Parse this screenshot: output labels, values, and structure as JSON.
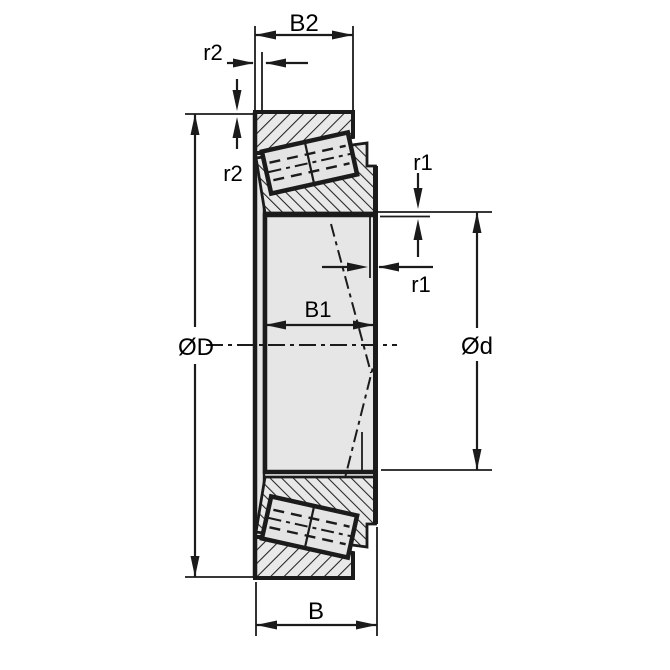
{
  "drawing": {
    "type": "engineering-dimension-drawing",
    "subject": "tapered roller bearing cross-section",
    "labels": {
      "cup_width": "B2",
      "r2_top": "r2",
      "r2_side": "r2",
      "r1_top": "r1",
      "r1_side": "r1",
      "outer_diameter": "ØD",
      "bore_diameter": "Ød",
      "inner_ring_width": "B1",
      "total_width": "B"
    },
    "colors": {
      "line": "#1b1b1b",
      "metal_fill": "#e6e6e6",
      "background": "#ffffff"
    }
  }
}
